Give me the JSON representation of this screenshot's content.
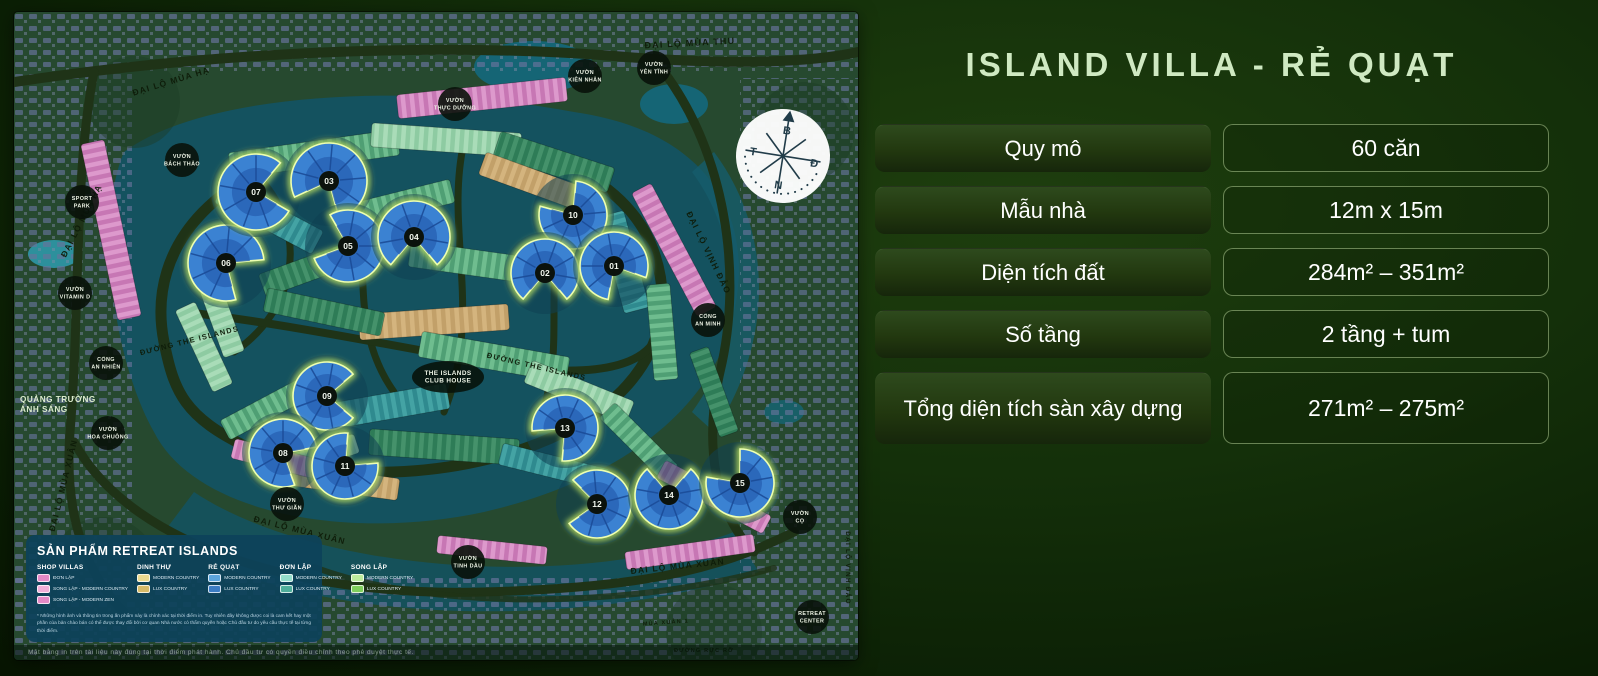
{
  "title": "ISLAND VILLA - RẺ QUẠT",
  "colors": {
    "title_mint": "#cfe9c2",
    "panel_bg": "#14300a",
    "legend_bg": "#0d425a",
    "fan_blue": "#3b82d2",
    "fan_glow": "#d9fb63"
  },
  "spec_table": {
    "rows": [
      {
        "label": "Quy mô",
        "value": "60 căn"
      },
      {
        "label": "Mẫu nhà",
        "value": "12m x 15m"
      },
      {
        "label": "Diện tích đất",
        "value": "284m² – 351m²"
      },
      {
        "label": "Số tầng",
        "value": "2 tầng + tum"
      },
      {
        "label": "Tổng diện tích sàn xây dựng",
        "value": "271m² – 275m²"
      }
    ]
  },
  "map": {
    "compass": {
      "north": "B",
      "east": "Đ",
      "south": "N",
      "west": "T"
    },
    "fans": [
      {
        "num": "06",
        "x": 212,
        "y": 251,
        "rot": 35,
        "r": 38
      },
      {
        "num": "07",
        "x": 242,
        "y": 180,
        "rot": -10,
        "r": 38
      },
      {
        "num": "03",
        "x": 315,
        "y": 169,
        "rot": 115,
        "r": 38
      },
      {
        "num": "05",
        "x": 334,
        "y": 234,
        "rot": 200,
        "r": 36
      },
      {
        "num": "04",
        "x": 400,
        "y": 225,
        "rot": 90,
        "r": 36
      },
      {
        "num": "10",
        "x": 559,
        "y": 203,
        "rot": 235,
        "r": 34
      },
      {
        "num": "02",
        "x": 531,
        "y": 261,
        "rot": 90,
        "r": 34
      },
      {
        "num": "01",
        "x": 600,
        "y": 254,
        "rot": 60,
        "r": 34
      },
      {
        "num": "09",
        "x": 313,
        "y": 384,
        "rot": 0,
        "r": 34
      },
      {
        "num": "08",
        "x": 269,
        "y": 441,
        "rot": 30,
        "r": 34
      },
      {
        "num": "11",
        "x": 331,
        "y": 454,
        "rot": -45,
        "r": 33
      },
      {
        "num": "13",
        "x": 551,
        "y": 416,
        "rot": 135,
        "r": 33
      },
      {
        "num": "12",
        "x": 583,
        "y": 492,
        "rot": 185,
        "r": 34
      },
      {
        "num": "14",
        "x": 655,
        "y": 483,
        "rot": 270,
        "r": 34
      },
      {
        "num": "15",
        "x": 726,
        "y": 471,
        "rot": 230,
        "r": 34
      }
    ],
    "road_labels": [
      {
        "text": "ĐẠI LỘ MÙA THU",
        "x": 676,
        "y": 34,
        "rot": -3,
        "size": 9
      },
      {
        "text": "ĐẠI LỘ MÙA HẠ",
        "x": 158,
        "y": 72,
        "rot": -17,
        "size": 8.5
      },
      {
        "text": "ĐẠI LỘ MÙA HẠ",
        "x": 70,
        "y": 210,
        "rot": -63,
        "size": 8.5
      },
      {
        "text": "ĐẠI LỘ VỊNH ĐẢO",
        "x": 692,
        "y": 242,
        "rot": 64,
        "size": 8.5
      },
      {
        "text": "ĐẠI LỘ VỊNH ĐẢO",
        "x": 832,
        "y": 556,
        "rot": 90,
        "size": 6.5
      },
      {
        "text": "ĐẠI LỘ MÙA XUÂN",
        "x": 52,
        "y": 474,
        "rot": -76,
        "size": 8.5
      },
      {
        "text": "ĐẠI LỘ MÙA XUÂN",
        "x": 285,
        "y": 521,
        "rot": 14,
        "size": 8.5
      },
      {
        "text": "ĐẠI LỘ MÙA XUÂN",
        "x": 664,
        "y": 557,
        "rot": -6,
        "size": 8.5
      },
      {
        "text": "ĐƯỜNG THE ISLANDS",
        "x": 176,
        "y": 331,
        "rot": -14,
        "size": 7.5
      },
      {
        "text": "ĐƯỜNG THE ISLANDS",
        "x": 522,
        "y": 357,
        "rot": 13,
        "size": 7.5
      },
      {
        "text": "MÙA XUÂN 1",
        "x": 652,
        "y": 612,
        "rot": -4,
        "size": 5.5
      },
      {
        "text": "ĐƯỜNG RỰC RỠ",
        "x": 690,
        "y": 640,
        "rot": 0,
        "size": 5.5
      }
    ],
    "place_labels": [
      {
        "lines": [
          "SPORT",
          "PARK"
        ],
        "x": 68,
        "y": 190
      },
      {
        "lines": [
          "VƯỜN",
          "BÁCH THẢO"
        ],
        "x": 168,
        "y": 148
      },
      {
        "lines": [
          "VƯỜN",
          "VITAMIN D"
        ],
        "x": 61,
        "y": 281
      },
      {
        "lines": [
          "VƯỜN",
          "THỰC DƯỠNG"
        ],
        "x": 441,
        "y": 92
      },
      {
        "lines": [
          "VƯỜN",
          "KIÊN NHẪN"
        ],
        "x": 571,
        "y": 64
      },
      {
        "lines": [
          "VƯỜN",
          "YÊN TĨNH"
        ],
        "x": 640,
        "y": 56
      },
      {
        "lines": [
          "CỔNG",
          "AN NHIÊN"
        ],
        "x": 92,
        "y": 351
      },
      {
        "lines": [
          "CỔNG",
          "AN MINH"
        ],
        "x": 694,
        "y": 308
      },
      {
        "lines": [
          "VƯỜN",
          "HOA CHUÔNG"
        ],
        "x": 94,
        "y": 421
      },
      {
        "lines": [
          "VƯỜN",
          "THƯ GIÃN"
        ],
        "x": 273,
        "y": 492
      },
      {
        "lines": [
          "VƯỜN",
          "TINH DẦU"
        ],
        "x": 454,
        "y": 550
      },
      {
        "lines": [
          "VƯỜN",
          "CỌ"
        ],
        "x": 786,
        "y": 505
      },
      {
        "lines": [
          "RETREAT",
          "CENTER"
        ],
        "x": 798,
        "y": 605
      },
      {
        "lines": [
          "THE ISLANDS",
          "CLUB HOUSE"
        ],
        "x": 434,
        "y": 365,
        "wide": true
      },
      {
        "lines": [
          "QUẢNG TRƯỜNG",
          "ÁNH SÁNG"
        ],
        "x": 6,
        "y": 390,
        "plain": true
      }
    ],
    "legend": {
      "title": "SẢN PHẨM RETREAT ISLANDS",
      "columns": [
        {
          "title": "SHOP VILLAS",
          "items": [
            {
              "label": "ĐƠN LẬP",
              "color": "#e589c6"
            },
            {
              "label": "SONG LẬP - MODERN COUNTRY",
              "color": "#f2aed8"
            },
            {
              "label": "SONG LẬP - MODERN ZEN",
              "color": "#e589c6"
            }
          ]
        },
        {
          "title": "DINH THỰ",
          "items": [
            {
              "label": "MODERN COUNTRY",
              "color": "#ecd98e"
            },
            {
              "label": "LUX COUNTRY",
              "color": "#d6ba67"
            }
          ]
        },
        {
          "title": "RẺ QUẠT",
          "items": [
            {
              "label": "MODERN COUNTRY",
              "color": "#5ba4dc"
            },
            {
              "label": "LUX COUNTRY",
              "color": "#3b7cc4"
            }
          ]
        },
        {
          "title": "ĐƠN LẬP",
          "items": [
            {
              "label": "MODERN COUNTRY",
              "color": "#93dcc9"
            },
            {
              "label": "LUX COUNTRY",
              "color": "#4fae9b"
            }
          ]
        },
        {
          "title": "SONG LẬP",
          "items": [
            {
              "label": "MODERN COUNTRY",
              "color": "#bdeb9d"
            },
            {
              "label": "LUX COUNTRY",
              "color": "#7fce5c"
            }
          ]
        }
      ],
      "footnote": "* Những hình ảnh và thông tin trong ấn phẩm này là chính xác tại thời điểm in. Tuy nhiên đây không được coi là cam kết hay một phần của bản chào bán có thể được thay đổi bởi cơ quan Nhà nước có thẩm quyền hoặc Chủ đầu tư do yêu cầu thực tế tại từng thời điểm."
    },
    "bottom_note": "Mặt bằng in trên tài liệu này đúng tại thời điểm phát hành. Chủ đầu tư có quyền điều chỉnh theo phê duyệt thực tế."
  }
}
